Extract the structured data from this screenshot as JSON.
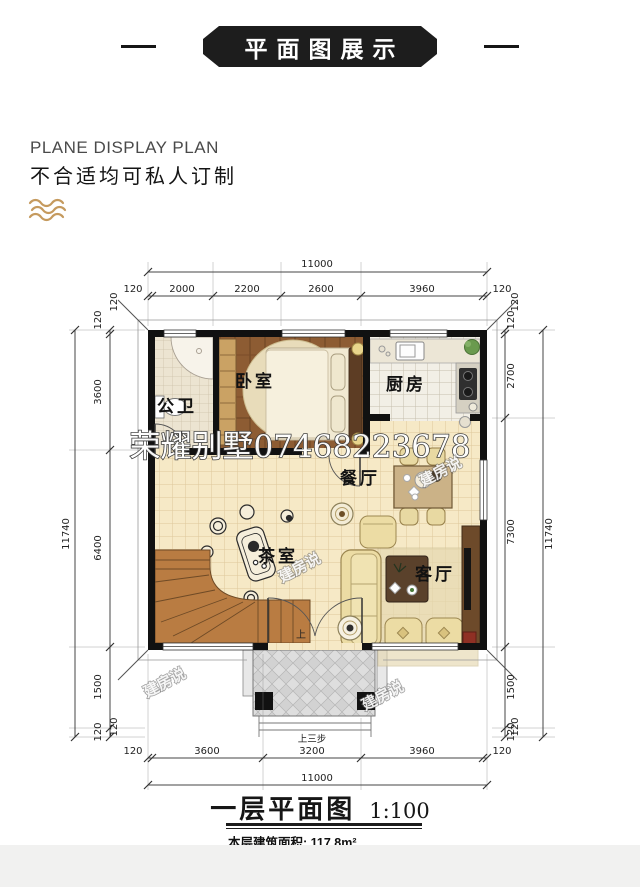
{
  "header": {
    "banner_title": "平面图展示",
    "subtitle_en": "PLANE DISPLAY PLAN",
    "subtitle_cn": "不合适均可私人订制"
  },
  "plan": {
    "watermark_main": "荣耀别墅07468223678",
    "watermark_diag": "建房说",
    "stair_up_label": "上",
    "rooms": [
      {
        "id": "bathroom",
        "label": "公卫"
      },
      {
        "id": "bedroom",
        "label": "卧室"
      },
      {
        "id": "kitchen",
        "label": "厨房"
      },
      {
        "id": "dining",
        "label": "餐厅"
      },
      {
        "id": "tearoom",
        "label": "茶室"
      },
      {
        "id": "living",
        "label": "客厅"
      }
    ],
    "dims": {
      "top_total": "11000",
      "top_segments": [
        "120",
        "2000",
        "2200",
        "2600",
        "3960",
        "120"
      ],
      "bottom_total": "11000",
      "bottom_segments": [
        "120",
        "3600",
        "3200",
        "3960",
        "120"
      ],
      "left_total": "11740",
      "left_segments": [
        "120",
        "3600",
        "6400",
        "1500",
        "120"
      ],
      "right_total": "11740",
      "right_segments": [
        "120",
        "2700",
        "7300",
        "1500",
        "120"
      ],
      "corner_offset": "120",
      "entry_steps_label": "上三步"
    }
  },
  "footer": {
    "plan_title": "一层平面图",
    "plan_scale": "1:100",
    "area_label": "本层建筑面积:",
    "area_value": "117.8m²"
  }
}
